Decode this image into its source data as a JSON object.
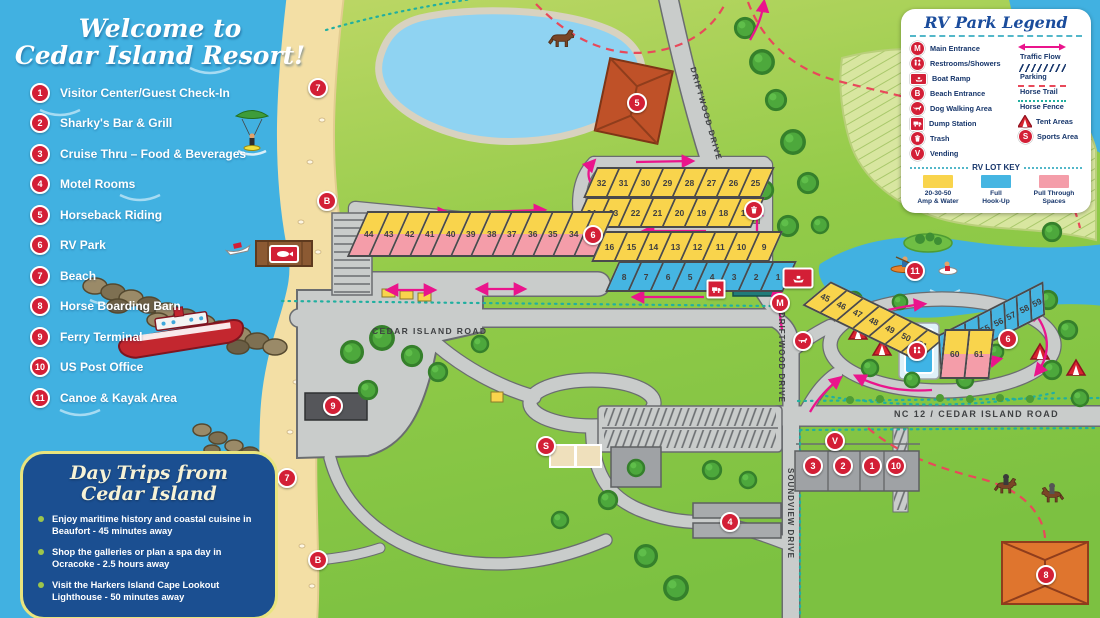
{
  "title_panel": {
    "line1": "Welcome to",
    "line2": "Cedar Island Resort!"
  },
  "locations": [
    {
      "num": "1",
      "label": "Visitor Center/Guest Check-In"
    },
    {
      "num": "2",
      "label": "Sharky's Bar & Grill"
    },
    {
      "num": "3",
      "label": "Cruise Thru – Food & Beverages"
    },
    {
      "num": "4",
      "label": "Motel Rooms"
    },
    {
      "num": "5",
      "label": "Horseback Riding"
    },
    {
      "num": "6",
      "label": "RV Park"
    },
    {
      "num": "7",
      "label": "Beach"
    },
    {
      "num": "8",
      "label": "Horse Boarding Barn"
    },
    {
      "num": "9",
      "label": "Ferry Terminal"
    },
    {
      "num": "10",
      "label": "US Post Office"
    },
    {
      "num": "11",
      "label": "Canoe & Kayak Area"
    }
  ],
  "legend": {
    "title": "RV Park Legend",
    "left_labels": [
      "Main Entrance",
      "Restrooms/Showers",
      "Boat Ramp",
      "Beach Entrance",
      "Dog Walking Area",
      "Dump Station",
      "Trash",
      "Vending"
    ],
    "right_labels": [
      "Traffic Flow",
      "Parking",
      "Horse Trail",
      "Horse Fence",
      "Tent Areas",
      "Sports Area"
    ],
    "lot_key_title": "RV LOT KEY",
    "lot_key": [
      {
        "l1": "20-30-50",
        "l2": "Amp & Water",
        "color": "#F9D44C"
      },
      {
        "l1": "Full",
        "l2": "Hook-Up",
        "color": "#45B5E2"
      },
      {
        "l1": "Pull Through",
        "l2": "Spaces",
        "color": "#F49DA9"
      }
    ]
  },
  "day_trips": {
    "title1": "Day Trips from",
    "title2": "Cedar Island",
    "items": [
      "Enjoy maritime history and coastal cuisine in Beaufort - 45 minutes away",
      "Shop the galleries or plan a spa day in Ocracoke - 2.5 hours away",
      "Visit the Harkers Island Cape Lookout Lighthouse - 50 minutes away"
    ]
  },
  "roads": {
    "cedar": "CEDAR ISLAND ROAD",
    "driftwood": "DRIFTWOOD DRIVE",
    "soundview": "SOUNDVIEW DRIVE",
    "nc12": "NC 12 / CEDAR ISLAND ROAD"
  },
  "markers": {
    "visitor": "1",
    "sharkys": "2",
    "cruise": "3",
    "motel": "4",
    "horseback": "5",
    "rv_park": "6",
    "beach": "7",
    "barn": "8",
    "ferry": "9",
    "post_office": "10",
    "canoe": "11",
    "main": "M",
    "beach_entrance": "B",
    "sports": "S",
    "vending": "V"
  },
  "rv_lots": {
    "row_a": [
      "32",
      "31",
      "30",
      "29",
      "28",
      "27",
      "26",
      "25"
    ],
    "row_b": [
      "24",
      "23",
      "22",
      "21",
      "20",
      "19",
      "18",
      "17"
    ],
    "row_c": [
      "16",
      "15",
      "14",
      "13",
      "12",
      "11",
      "10",
      "9"
    ],
    "row_d": [
      "8",
      "7",
      "6",
      "5",
      "4",
      "3",
      "2",
      "1"
    ],
    "row_e": [
      "44",
      "43",
      "42",
      "41",
      "40",
      "39",
      "38",
      "37",
      "36",
      "35",
      "34",
      "33"
    ],
    "row_f_yellow": [
      "45",
      "46",
      "47",
      "48",
      "49",
      "50",
      "51"
    ],
    "row_f_blue": [
      "52",
      "53",
      "54",
      "55",
      "56",
      "57",
      "58",
      "59"
    ],
    "row_g": [
      "60",
      "61"
    ]
  },
  "colors": {
    "marker_red": "#D31F36",
    "lot_yellow": "#F9D44C",
    "lot_blue": "#45B5E2",
    "lot_pink": "#F49DA9",
    "arrow_magenta": "#EA148C",
    "horse_trail_red": "#E8495A",
    "horse_fence_teal": "#21AFA0",
    "water_blue": "#41B1E1",
    "sand": "#F3DFA5",
    "land_green": "#7CC141"
  }
}
